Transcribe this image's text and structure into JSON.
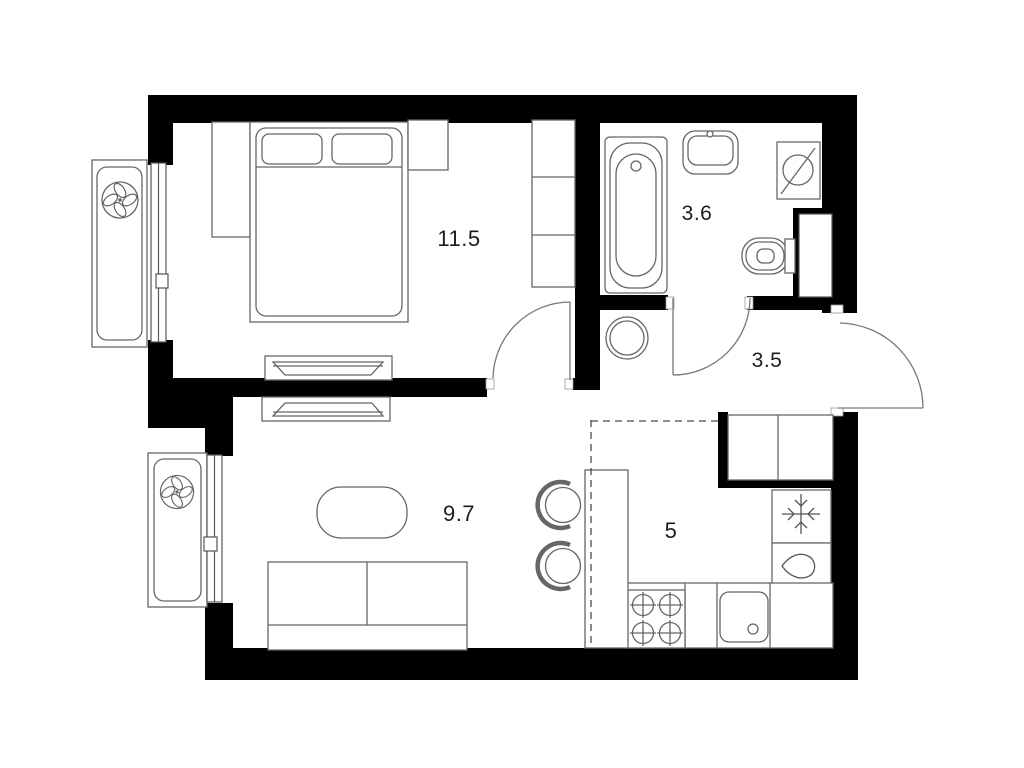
{
  "colors": {
    "background": "#ffffff",
    "walls": "#000000",
    "furniture_lines": "#666666",
    "labels": "#1d1d1d"
  },
  "rooms": [
    {
      "id": "bedroom",
      "area": "11.5"
    },
    {
      "id": "bathroom",
      "area": "3.6"
    },
    {
      "id": "hallway",
      "area": "3.5"
    },
    {
      "id": "living-room",
      "area": "9.7"
    },
    {
      "id": "kitchen",
      "area": "5"
    }
  ],
  "fixtures": [
    "double-bed",
    "pillows",
    "dresser",
    "nightstand",
    "wardrobe",
    "tv-unit-bedroom",
    "tv-unit-living",
    "sofa",
    "coffee-table",
    "bathtub",
    "washbasin",
    "toilet",
    "water-heater-box",
    "duct-shaft",
    "washing-machine",
    "fridge-snowflake",
    "water-drop",
    "stove-burners",
    "kitchen-sink",
    "kitchen-counter",
    "bar-table",
    "chairs",
    "ac-fan-unit-bedroom",
    "ac-fan-unit-living",
    "window-bedroom",
    "window-living",
    "door-bedroom",
    "door-bathroom",
    "entrance-door",
    "dashed-zone-boundary"
  ]
}
